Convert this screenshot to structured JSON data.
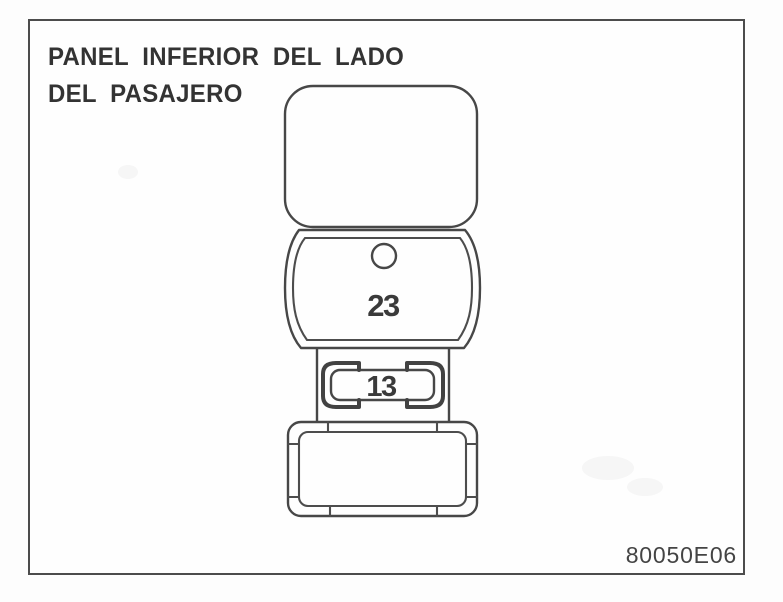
{
  "document": {
    "title_line1": "PANEL INFERIOR DEL LADO",
    "title_line2": "DEL PASAJERO",
    "figure_code": "80050E06"
  },
  "diagram": {
    "description": "fuse and relay component stack, passenger side lower panel",
    "labels": {
      "relay_number": "23",
      "fuse_number": "13"
    },
    "line_color": "#474747",
    "text_color": "#3a3a3a"
  }
}
